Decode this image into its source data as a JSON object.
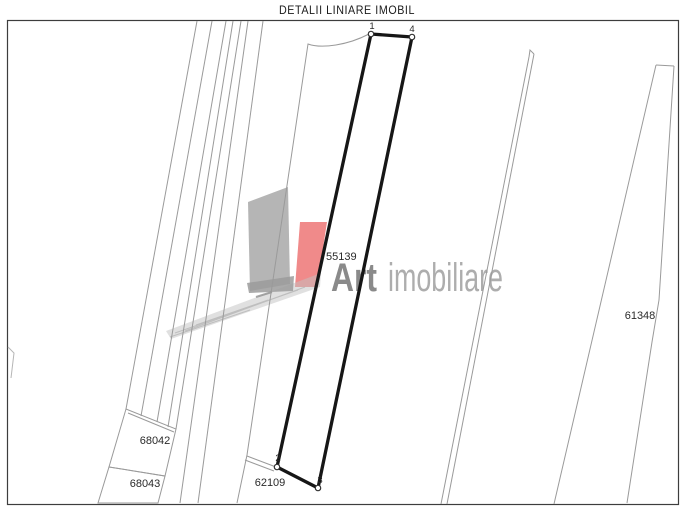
{
  "title": "DETALII LINIARE IMOBIL",
  "watermark": {
    "brand_bold": "Art",
    "brand_light": "imobiliare"
  },
  "colors": {
    "watermark_gray": "#b5b5b5",
    "watermark_red": "#f08a8a",
    "watermark_shadow": "#9b9b9b",
    "streak_gray": "#c2c2c2",
    "bold_parcel_stroke": "#161616",
    "thin_line": "#9a9a9a"
  },
  "map": {
    "parcel_labels": {
      "main": "55139",
      "left_upper": "68042",
      "left_lower": "68043",
      "bottom": "62109",
      "right": "61348"
    },
    "vertex_labels": {
      "v1": "1",
      "v2": "2",
      "v3": "3",
      "v4": "4"
    }
  }
}
